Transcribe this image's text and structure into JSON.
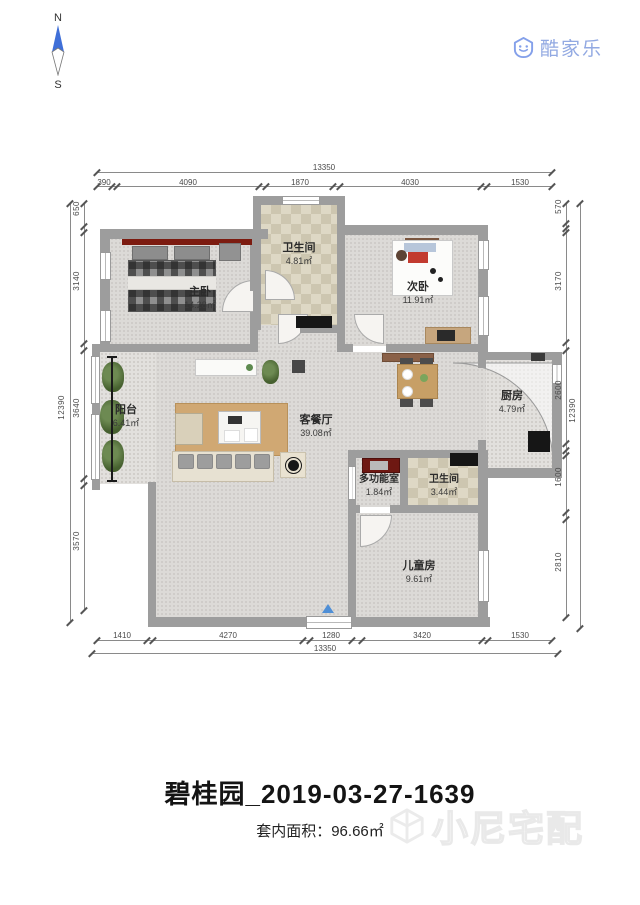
{
  "compass": {
    "north": "N",
    "south": "S"
  },
  "logo": {
    "brand": "酷家乐"
  },
  "rooms": [
    {
      "name": "主卧",
      "area": "14.28㎡"
    },
    {
      "name": "卫生间",
      "area": "4.81㎡"
    },
    {
      "name": "次卧",
      "area": "11.91㎡"
    },
    {
      "name": "阳台",
      "area": "6.41㎡"
    },
    {
      "name": "客餐厅",
      "area": "39.08㎡"
    },
    {
      "name": "厨房",
      "area": "4.79㎡"
    },
    {
      "name": "多功能室",
      "area": "1.84㎡"
    },
    {
      "name": "卫生间",
      "area": "3.44㎡"
    },
    {
      "name": "儿童房",
      "area": "9.61㎡"
    }
  ],
  "dimensions": {
    "top": {
      "total": "13350",
      "segments": [
        "390",
        "4090",
        "1870",
        "4030",
        "1530"
      ]
    },
    "bottom": {
      "total": "13350",
      "segments": [
        "1410",
        "4270",
        "1280",
        "3420",
        "1530"
      ]
    },
    "left": {
      "total": "12390",
      "segments": [
        "650",
        "3140",
        "3640",
        "3570"
      ]
    },
    "right": {
      "total": "12390",
      "segments": [
        "570",
        "3170",
        "2600",
        "1600",
        "2810"
      ]
    }
  },
  "footer": {
    "title": "碧桂园_2019-03-27-1639",
    "area_text": "套内面积：96.66㎡"
  },
  "watermark": {
    "text": "小尼宅配"
  }
}
